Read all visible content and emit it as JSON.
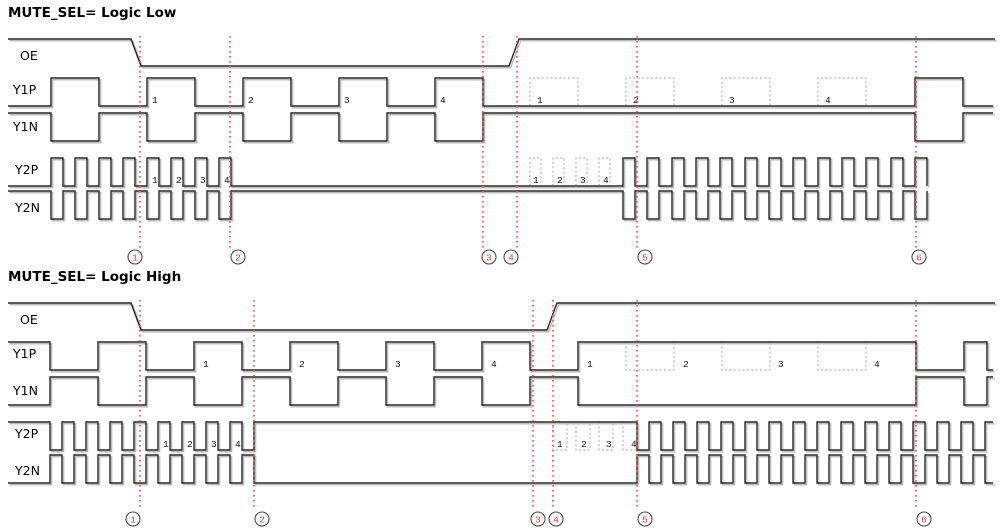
{
  "canvas": {
    "width": 1001,
    "height": 532,
    "background": "#ffffff"
  },
  "colors": {
    "wave": "#262626",
    "wave_shadow": "#bdbdbd",
    "dashed_outline": "#b9b9b9",
    "marker_red": "#fa5548",
    "circle_stroke": "#4d4d4d",
    "circle_number": "#e93c2e",
    "pulse_number": "#111111"
  },
  "panels": [
    {
      "title": "MUTE_SEL= Logic Low",
      "title_top": 5,
      "signals": [
        {
          "name": "OE",
          "x": 20,
          "y": 48
        },
        {
          "name": "Y1P",
          "x": 13,
          "y": 82
        },
        {
          "name": "Y1N",
          "x": 13,
          "y": 119
        },
        {
          "name": "Y2P",
          "x": 15,
          "y": 162
        },
        {
          "name": "Y2N",
          "x": 15,
          "y": 200
        }
      ],
      "waves": [
        {
          "name": "OE",
          "type": "poly",
          "points": [
            [
              8,
              39
            ],
            [
              131,
              39
            ],
            [
              141,
              66
            ],
            [
              509,
              66
            ],
            [
              519,
              39
            ],
            [
              995,
              39
            ]
          ]
        },
        {
          "name": "Y1P",
          "type": "square",
          "hi": 78,
          "lo": 106,
          "x0": 8,
          "x1": 993,
          "start": "lo",
          "toggles": [
            51,
            99,
            147,
            195,
            243,
            291,
            339,
            387,
            435,
            483,
            915,
            963
          ]
        },
        {
          "name": "Y1N",
          "type": "square",
          "hi": 113,
          "lo": 141,
          "x0": 8,
          "x1": 993,
          "start": "hi",
          "toggles": [
            51,
            99,
            147,
            195,
            243,
            291,
            339,
            387,
            435,
            483,
            915,
            963
          ]
        },
        {
          "name": "Y2P",
          "type": "square",
          "hi": 158,
          "lo": 186,
          "x0": 8,
          "x1": 927,
          "start": "lo",
          "toggles": [
            51,
            63,
            75,
            87,
            99,
            111,
            123,
            135,
            147,
            159,
            171,
            183,
            195,
            207,
            219,
            231,
            623,
            635,
            647,
            659,
            672,
            684,
            696,
            708,
            720,
            732,
            745,
            757,
            769,
            781,
            793,
            805,
            818,
            830,
            842,
            854,
            866,
            878,
            891,
            903,
            915,
            927
          ]
        },
        {
          "name": "Y2N",
          "type": "square",
          "hi": 191,
          "lo": 219,
          "x0": 8,
          "x1": 927,
          "start": "hi",
          "toggles": [
            51,
            63,
            75,
            87,
            99,
            111,
            123,
            135,
            147,
            159,
            171,
            183,
            195,
            207,
            219,
            231,
            623,
            635,
            647,
            659,
            672,
            684,
            696,
            708,
            720,
            732,
            745,
            757,
            769,
            781,
            793,
            805,
            818,
            830,
            842,
            854,
            866,
            878,
            891,
            903,
            915,
            927
          ]
        }
      ],
      "dashed_boxes": [
        {
          "signal": "Y1P",
          "base": 106,
          "top": 78,
          "ranges": [
            [
              530,
              578
            ],
            [
              626,
              674
            ],
            [
              722,
              770
            ],
            [
              818,
              866
            ]
          ]
        },
        {
          "signal": "Y2P",
          "base": 186,
          "top": 158,
          "ranges": [
            [
              530,
              541
            ],
            [
              553,
              564
            ],
            [
              576,
              587
            ],
            [
              599,
              610
            ]
          ]
        }
      ],
      "wave_labels": [
        {
          "y": 103,
          "items": [
            [
              152,
              "1"
            ],
            [
              248,
              "2"
            ],
            [
              344,
              "3"
            ],
            [
              440,
              "4"
            ],
            [
              537,
              "1"
            ],
            [
              633,
              "2"
            ],
            [
              729,
              "3"
            ],
            [
              825,
              "4"
            ]
          ]
        },
        {
          "y": 183,
          "items": [
            [
              152,
              "1"
            ],
            [
              176,
              "2"
            ],
            [
              200,
              "3"
            ],
            [
              224,
              "4"
            ],
            [
              533,
              "1"
            ],
            [
              557,
              "2"
            ],
            [
              580,
              "3"
            ],
            [
              603,
              "4"
            ]
          ]
        }
      ],
      "markers": {
        "y1": 36,
        "y2": 248,
        "lines": [
          140,
          230,
          483,
          517,
          637,
          916
        ],
        "circles": {
          "cy": 257,
          "r": 7,
          "items": [
            [
              135,
              "1"
            ],
            [
              238,
              "2"
            ],
            [
              489,
              "3"
            ],
            [
              511,
              "4"
            ],
            [
              645,
              "5"
            ],
            [
              919,
              "6"
            ]
          ]
        }
      }
    },
    {
      "title": "MUTE_SEL= Logic High",
      "title_top": 269,
      "signals": [
        {
          "name": "OE",
          "x": 20,
          "y": 312
        },
        {
          "name": "Y1P",
          "x": 13,
          "y": 346
        },
        {
          "name": "Y1N",
          "x": 13,
          "y": 383
        },
        {
          "name": "Y2P",
          "x": 15,
          "y": 426
        },
        {
          "name": "Y2N",
          "x": 15,
          "y": 463
        }
      ],
      "waves": [
        {
          "name": "OE",
          "type": "poly",
          "points": [
            [
              8,
              303
            ],
            [
              131,
              303
            ],
            [
              141,
              330
            ],
            [
              547,
              330
            ],
            [
              557,
              303
            ],
            [
              995,
              303
            ]
          ]
        },
        {
          "name": "Y1P",
          "type": "square",
          "hi": 342,
          "lo": 370,
          "x0": 8,
          "x1": 993,
          "start": "hi",
          "toggles": [
            50,
            98,
            146,
            194,
            242,
            290,
            338,
            386,
            434,
            482,
            530,
            578,
            916,
            964,
            987
          ]
        },
        {
          "name": "Y1N",
          "type": "square",
          "hi": 377,
          "lo": 405,
          "x0": 8,
          "x1": 993,
          "start": "lo",
          "toggles": [
            50,
            98,
            146,
            194,
            242,
            290,
            338,
            386,
            434,
            482,
            530,
            578,
            916,
            964,
            987
          ]
        },
        {
          "name": "Y2P",
          "type": "square",
          "hi": 422,
          "lo": 450,
          "x0": 8,
          "x1": 993,
          "start": "hi",
          "toggles": [
            50,
            62,
            74,
            86,
            98,
            110,
            122,
            134,
            146,
            158,
            170,
            182,
            194,
            206,
            218,
            230,
            242,
            254,
            637,
            649,
            661,
            673,
            685,
            697,
            709,
            721,
            733,
            745,
            757,
            769,
            781,
            793,
            805,
            817,
            829,
            841,
            853,
            865,
            877,
            889,
            901,
            913,
            925,
            937,
            949,
            961,
            973,
            985
          ]
        },
        {
          "name": "Y2N",
          "type": "square",
          "hi": 455,
          "lo": 483,
          "x0": 8,
          "x1": 993,
          "start": "lo",
          "toggles": [
            50,
            62,
            74,
            86,
            98,
            110,
            122,
            134,
            146,
            158,
            170,
            182,
            194,
            206,
            218,
            230,
            242,
            254,
            637,
            649,
            661,
            673,
            685,
            697,
            709,
            721,
            733,
            745,
            757,
            769,
            781,
            793,
            805,
            817,
            829,
            841,
            853,
            865,
            877,
            889,
            901,
            913,
            925,
            937,
            949,
            961,
            973,
            985
          ]
        }
      ],
      "dashed_boxes": [
        {
          "signal": "Y1P",
          "base": 342,
          "top": 370,
          "ranges": [
            [
              626,
              674
            ],
            [
              722,
              770
            ],
            [
              818,
              866
            ]
          ]
        },
        {
          "signal": "Y2P",
          "base": 422,
          "top": 450,
          "ranges": [
            [
              553,
              567
            ],
            [
              576,
              590
            ],
            [
              599,
              613
            ],
            [
              623,
              637
            ]
          ]
        }
      ],
      "wave_labels": [
        {
          "y": 367,
          "items": [
            [
              203,
              "1"
            ],
            [
              299,
              "2"
            ],
            [
              395,
              "3"
            ],
            [
              491,
              "4"
            ],
            [
              587,
              "1"
            ],
            [
              683,
              "2"
            ],
            [
              778,
              "3"
            ],
            [
              874,
              "4"
            ]
          ]
        },
        {
          "y": 447,
          "items": [
            [
              163,
              "1"
            ],
            [
              187,
              "2"
            ],
            [
              211,
              "3"
            ],
            [
              235,
              "4"
            ],
            [
              557,
              "1"
            ],
            [
              581,
              "2"
            ],
            [
              606,
              "3"
            ],
            [
              631,
              "4"
            ]
          ]
        }
      ],
      "markers": {
        "y1": 300,
        "y2": 510,
        "lines": [
          140,
          254,
          533,
          553,
          637,
          916
        ],
        "circles": {
          "cy": 519,
          "r": 7,
          "items": [
            [
              133,
              "1"
            ],
            [
              262,
              "2"
            ],
            [
              538,
              "3"
            ],
            [
              556,
              "4"
            ],
            [
              645,
              "5"
            ],
            [
              924,
              "6"
            ]
          ]
        }
      }
    }
  ]
}
